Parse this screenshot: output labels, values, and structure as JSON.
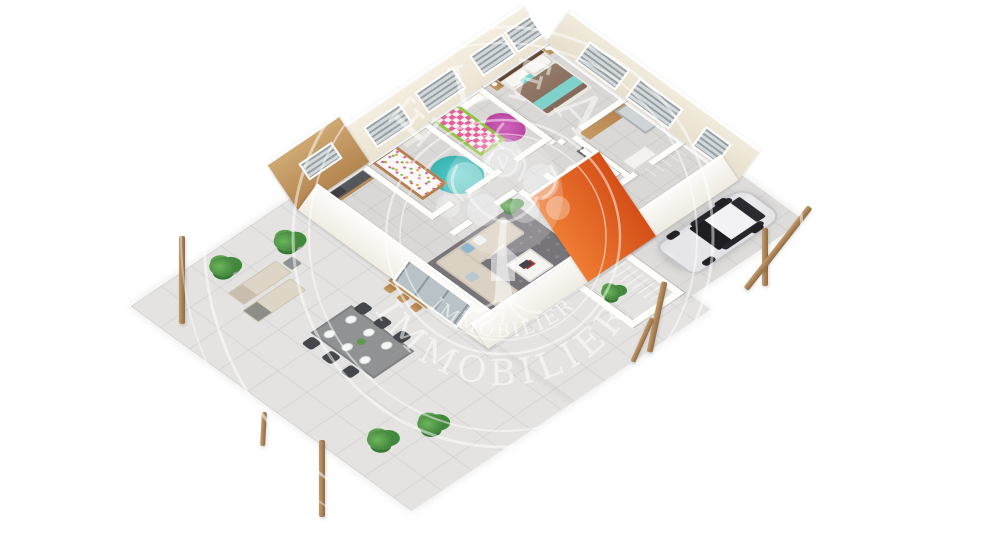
{
  "meta": {
    "canvas_width": 1000,
    "canvas_height": 536,
    "background": "#ffffff",
    "description": "3D isometric dollhouse floor-plan render of a single-storey house with terrace, carport, parked SUV and a circular real-estate watermark"
  },
  "watermark": {
    "top_text": "ELFA",
    "bottom_text": "IMMOBILIER",
    "ring_text": "IMMOBILIER",
    "monogram": "V",
    "color": "rgba(255,255,255,0.55)"
  },
  "palette": {
    "background": "#ffffff",
    "terrace_tile": "#e4e3e1",
    "carport_tile": "#dddcda",
    "interior_tile": "#d9d8d6",
    "wall_white": "#fdfdfb",
    "wall_cream": "#f0e9d9",
    "wood": "#b5804f",
    "kitchen_counter": "#54575c",
    "orange_wall": "#e0571e",
    "teal_rug": "#41c3c3",
    "pink_rug": "#c94fae",
    "green_kids_bed": "#8ec63f",
    "master_blanket": "#8d7263",
    "teal_throw": "#7fd2cb",
    "sofa_beige": "#dcd2c4",
    "living_rug": "#77747a",
    "car_body": "#e9e9ec",
    "plant_green": "#47893c"
  },
  "scene": {
    "rooms": [
      {
        "name": "kitchen"
      },
      {
        "name": "kids-bedroom-1"
      },
      {
        "name": "kids-bedroom-2"
      },
      {
        "name": "master-bedroom"
      },
      {
        "name": "bathroom"
      },
      {
        "name": "wc"
      },
      {
        "name": "hallway"
      },
      {
        "name": "living-room"
      },
      {
        "name": "entrance"
      },
      {
        "name": "porch"
      }
    ],
    "exterior": [
      {
        "name": "terrace"
      },
      {
        "name": "carport"
      },
      {
        "name": "suv-car"
      },
      {
        "name": "outdoor-dining-table",
        "seats": 6
      },
      {
        "name": "sun-loungers",
        "count": 2
      },
      {
        "name": "potted-plants",
        "count": 6
      },
      {
        "name": "pergola-posts",
        "count": 7
      }
    ]
  }
}
